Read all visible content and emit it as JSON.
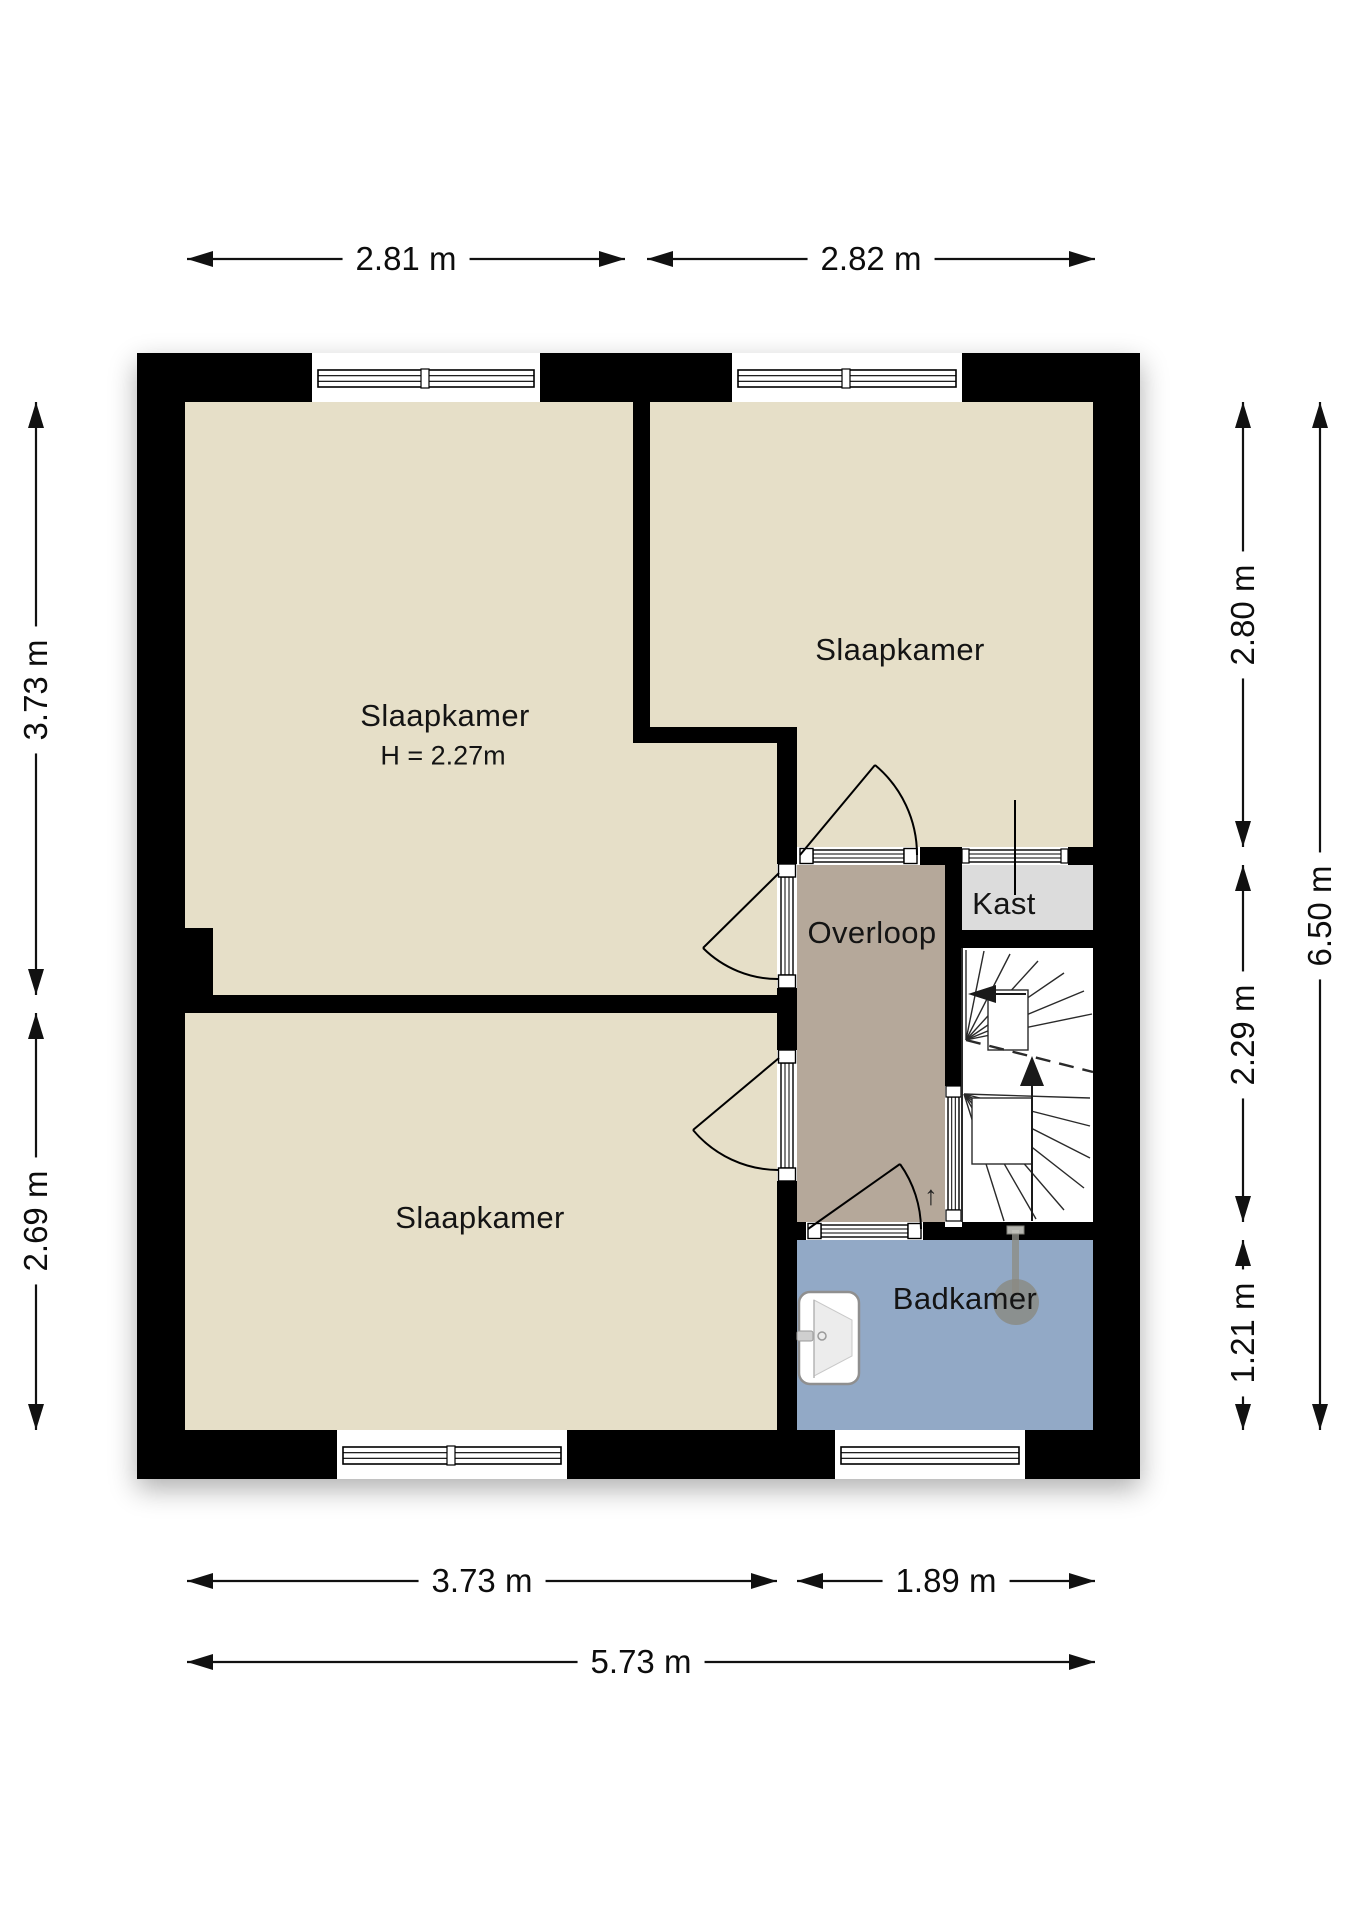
{
  "rooms": {
    "bedroomTopLeft": {
      "label": "Slaapkamer",
      "heightNote": "H = 2.27m"
    },
    "bedroomTopRight": {
      "label": "Slaapkamer"
    },
    "bedroomBottomLeft": {
      "label": "Slaapkamer"
    },
    "landing": {
      "label": "Overloop"
    },
    "closet": {
      "label": "Kast"
    },
    "bathroom": {
      "label": "Badkamer"
    },
    "stairs": {
      "upMarker": "↑"
    }
  },
  "dimensions": {
    "top": [
      "2.81 m",
      "2.82 m"
    ],
    "bottomInner": [
      "3.73 m",
      "1.89 m"
    ],
    "bottomTotal": "5.73 m",
    "left": [
      "3.73 m",
      "2.69 m"
    ],
    "rightInner": [
      "2.80 m",
      "2.29 m",
      "1.21 m"
    ],
    "rightTotal": "6.50 m"
  },
  "fixtures": {
    "sink": "washbasin",
    "shower": "shower-head",
    "stairUpArrow": "walk-line-up"
  },
  "colors": {
    "wall": "#000000",
    "room": "#e6dfc8",
    "landing": "#b5a89a",
    "closet": "#dcdcdc",
    "bathroom": "#92a9c6",
    "stairs": "#ffffff",
    "dimension": "#111111"
  }
}
